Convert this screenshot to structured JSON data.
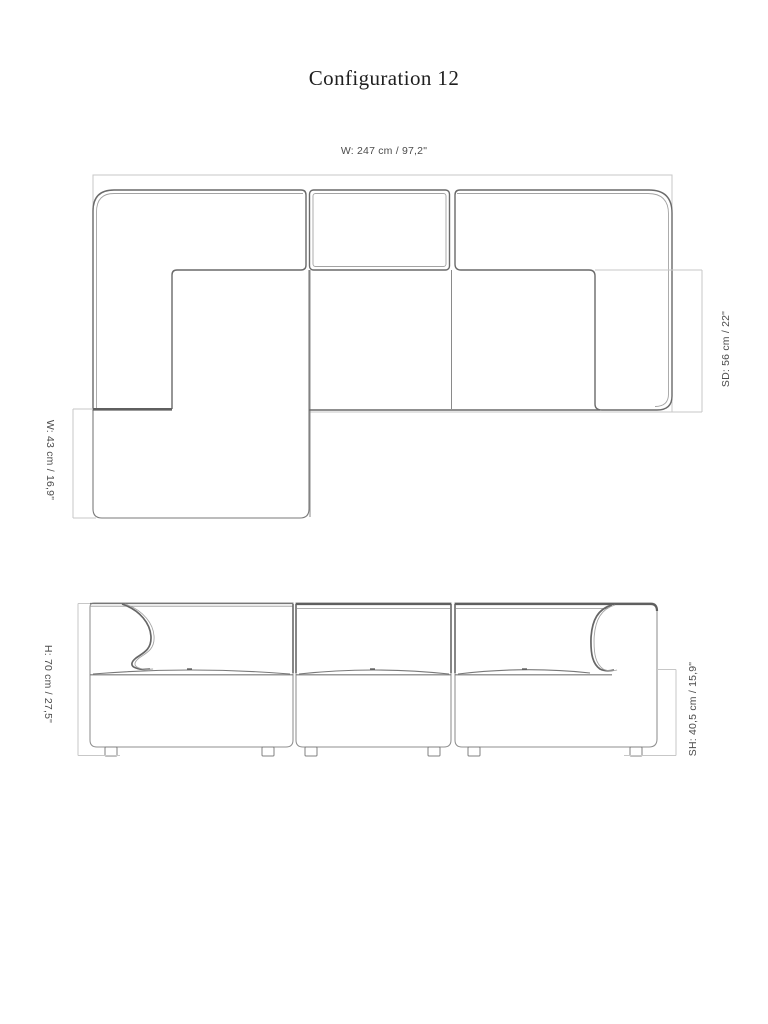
{
  "title": "Configuration 12",
  "plan": {
    "dim_width": "W: 247 cm / 97,2\"",
    "dim_seat_depth": "SD: 56 cm / 22\"",
    "dim_chaise_width": "W: 43 cm / 16,9\""
  },
  "front": {
    "dim_height": "H: 70 cm / 27,5\"",
    "dim_seat_height": "SH: 40,5 cm / 15,9\""
  },
  "colors": {
    "background": "#ffffff",
    "outline": "#6a6a6a",
    "outline_bold": "#5f5f5f",
    "outline_echo": "#a3a3a3",
    "dimension_line": "#c7c7c7",
    "label_text": "#4c4c4c",
    "title_text": "#1f1f1f"
  }
}
